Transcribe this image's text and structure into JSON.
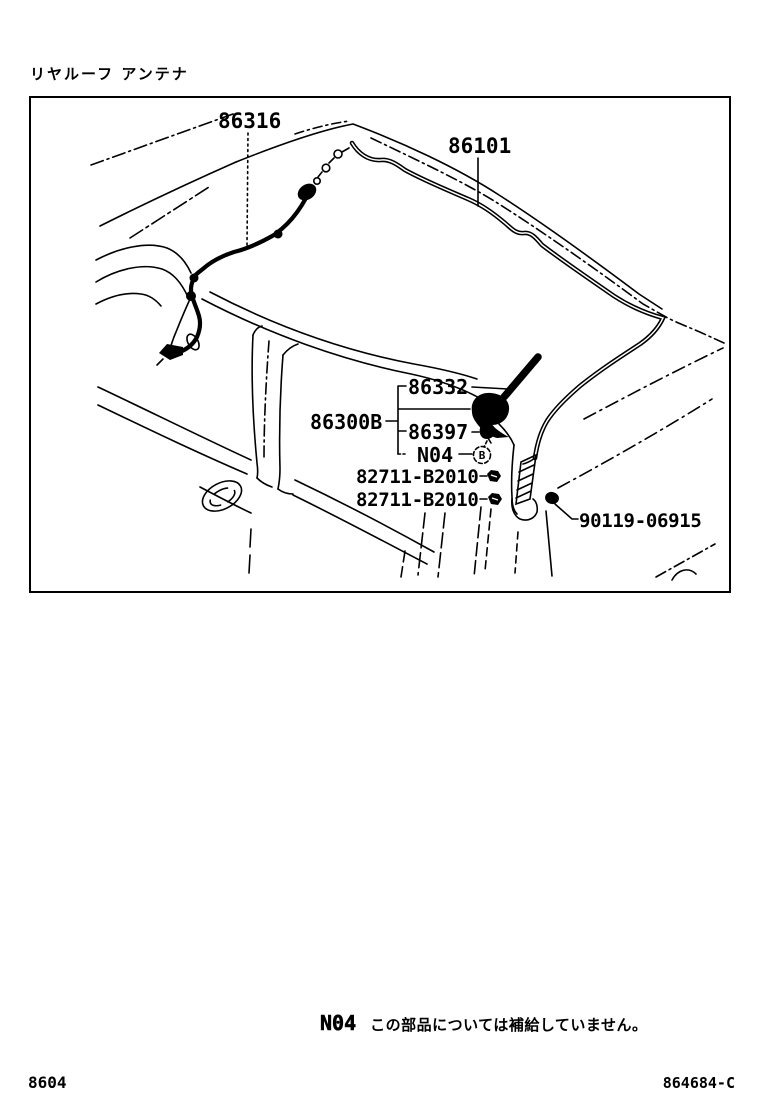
{
  "page": {
    "title": "リヤルーフ アンテナ",
    "footer_left": "8604",
    "footer_right": "864684-C"
  },
  "note": {
    "code": "N04",
    "text": "この部品については補給していません。"
  },
  "diagram": {
    "labels": {
      "l86316": "86316",
      "l86101": "86101",
      "l86332": "86332",
      "l86300B": "86300B",
      "l86397": "86397",
      "lN04": "N04",
      "l82711a": "82711-B2010",
      "l82711b": "82711-B2010",
      "l90119": "90119-06915",
      "circled_letter": "B"
    }
  }
}
